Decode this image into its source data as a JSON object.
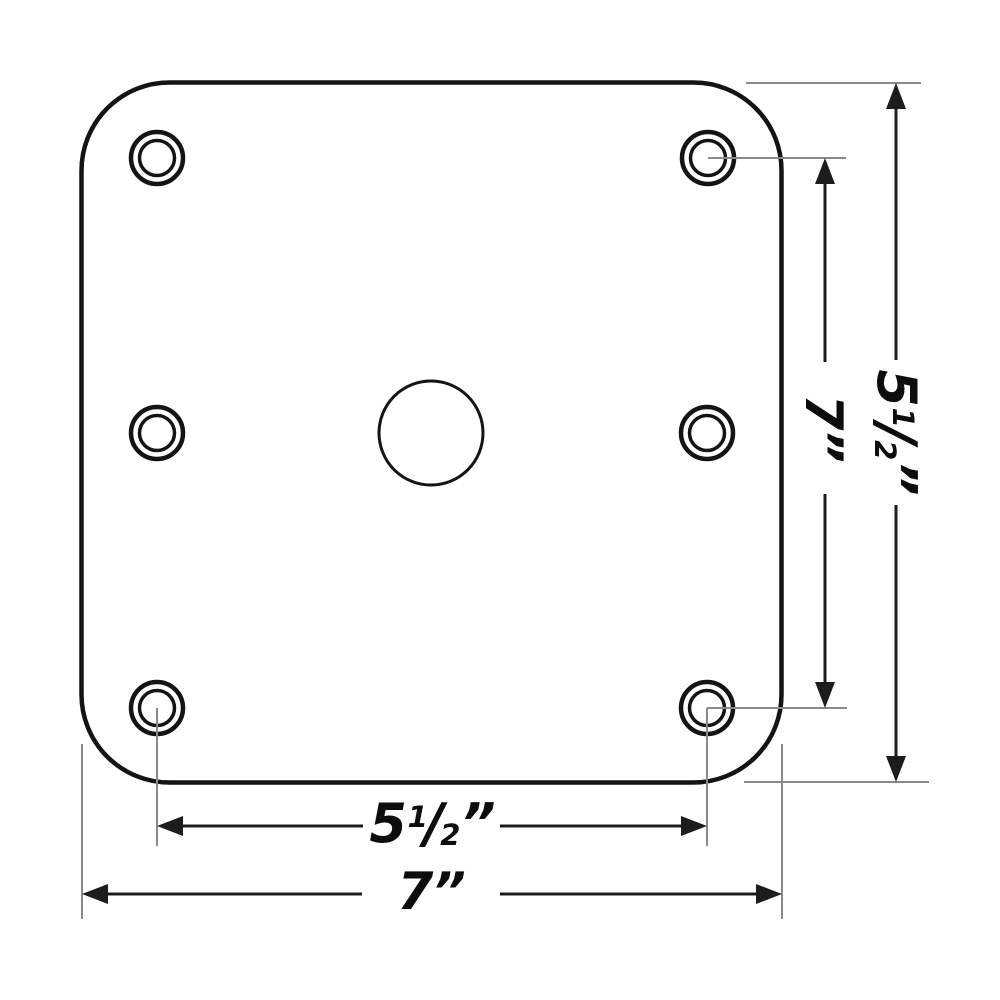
{
  "colors": {
    "background": "#ffffff",
    "outline": "#141414",
    "dimension_line": "#1c1c1c",
    "extension_line": "#8a8a8a",
    "label_text": "#0d0d0d"
  },
  "labels": {
    "bottom_inner_width": {
      "full": "5 1/2”",
      "whole": "5",
      "numerator": "1",
      "slash": "/",
      "denominator": "2",
      "unit": "”"
    },
    "bottom_outer_width": {
      "full": "7”",
      "value": "7”"
    },
    "right_inner_height": {
      "full": "7”",
      "value": "7”"
    },
    "right_outer_height": {
      "full": "5 1/2”",
      "whole": "5",
      "numerator": "1",
      "slash": "/",
      "denominator": "2",
      "unit": "”"
    }
  }
}
